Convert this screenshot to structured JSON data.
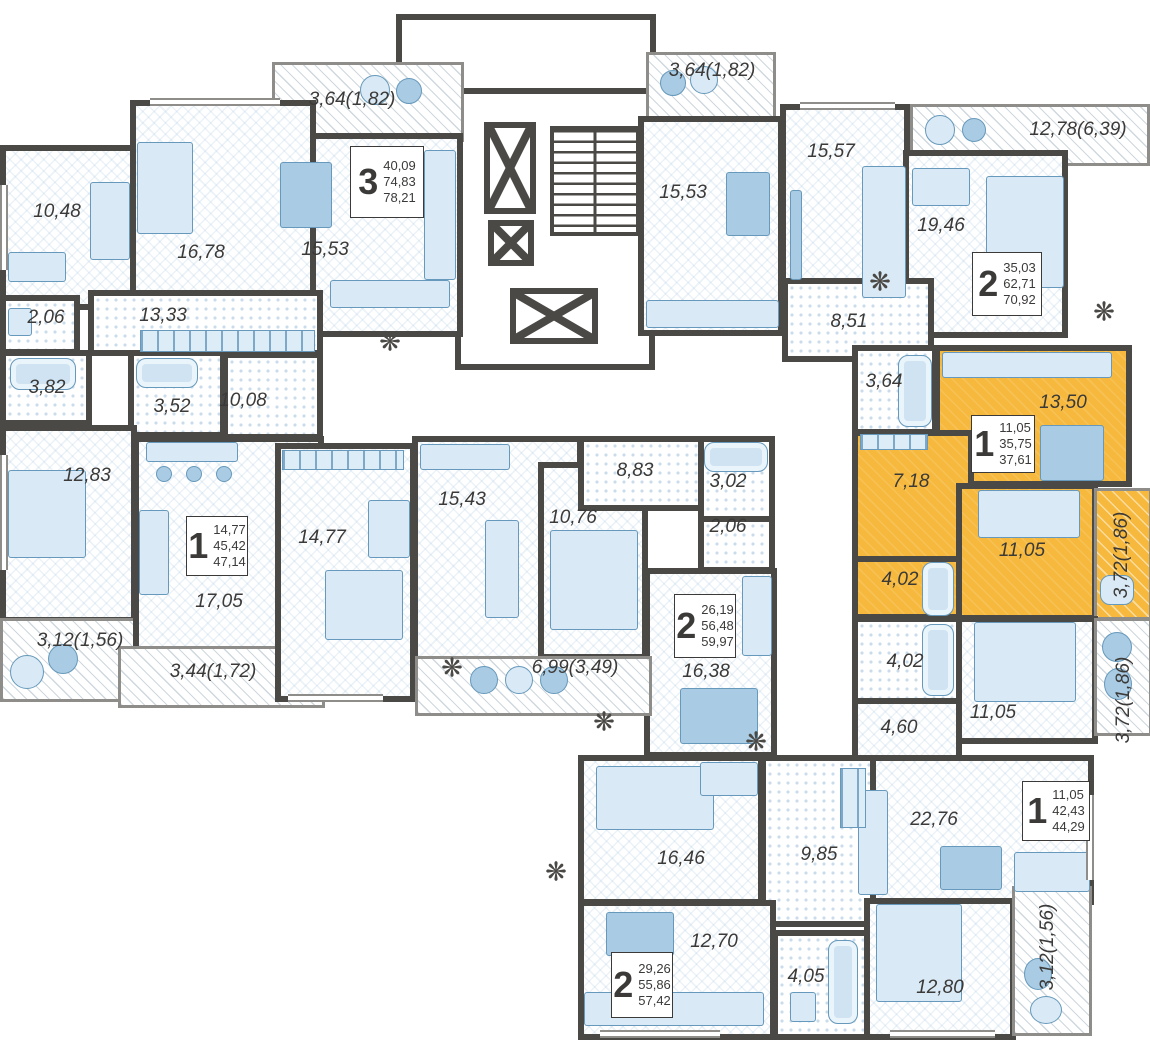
{
  "title": "Residential floor plan with highlighted apartment",
  "colors": {
    "wall": "#4b4946",
    "highlight_apartment": "#F6B93E",
    "furniture": "#c9dff0",
    "text": "#3b3a38"
  },
  "apartments": {
    "a3": {
      "number": "3",
      "living": "40,09",
      "total": "74,83",
      "full": "78,21"
    },
    "a1ml": {
      "number": "1",
      "living": "14,77",
      "total": "45,42",
      "full": "47,14"
    },
    "a2c": {
      "number": "2",
      "living": "26,19",
      "total": "56,48",
      "full": "59,97"
    },
    "a2tr": {
      "number": "2",
      "living": "35,03",
      "total": "62,71",
      "full": "70,92"
    },
    "a1y": {
      "number": "1",
      "living": "11,05",
      "total": "35,75",
      "full": "37,61"
    },
    "a1br": {
      "number": "1",
      "living": "11,05",
      "total": "42,43",
      "full": "44,29"
    },
    "a2bc": {
      "number": "2",
      "living": "29,26",
      "total": "55,86",
      "full": "57,42"
    }
  },
  "rooms": {
    "b364tl": "3,64(1,82)",
    "r1048": "10,48",
    "r1678": "16,78",
    "r1553l": "15,53",
    "h1333": "13,33",
    "wc206l": "2,06",
    "b382": "3,82",
    "b352": "3,52",
    "h1008": "10,08",
    "r1283": "12,83",
    "balc312l": "3,12(1,56)",
    "k1705": "17,05",
    "balc344": "3,44(1,72)",
    "r1477": "14,77",
    "r1543": "15,43",
    "r1076": "10,76",
    "h883": "8,83",
    "b302": "3,02",
    "wc206c": "2,06",
    "k1638": "16,38",
    "balc699": "6,99(3,49)",
    "balc364tr": "3,64(1,82)",
    "k1553r": "15,53",
    "r1557": "15,57",
    "r1946": "19,46",
    "balc1278": "12,78(6,39)",
    "h851": "8,51",
    "y364": "3,64",
    "y1350": "13,50",
    "y718": "7,18",
    "y1105": "11,05",
    "y402": "4,02",
    "ybalc372": "3,72(1,86)",
    "b402r": "4,02",
    "r1105r": "11,05",
    "h460": "4,60",
    "balc372r": "3,72(1,86)",
    "k2276": "22,76",
    "r1280": "12,80",
    "balc312br": "3,12(1,56)",
    "r1646": "16,46",
    "h985": "9,85",
    "k1270": "12,70",
    "b405": "4,05"
  }
}
